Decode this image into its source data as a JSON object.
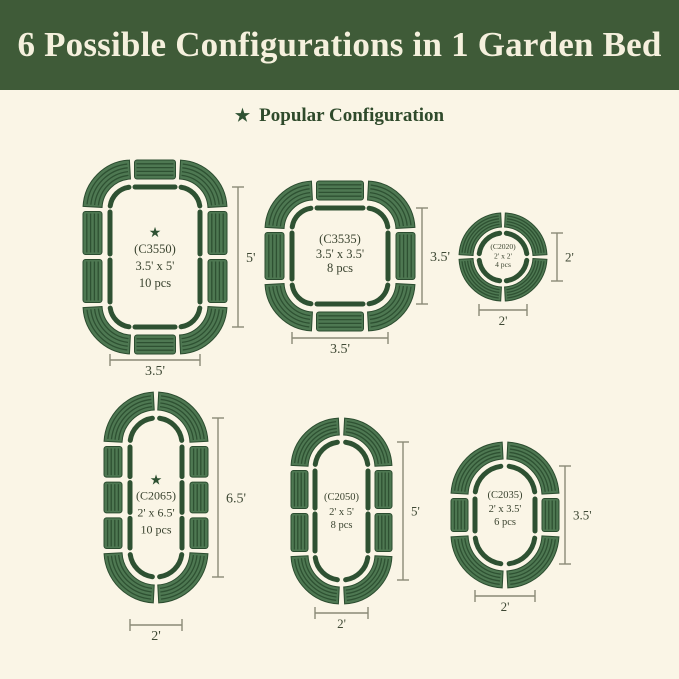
{
  "page": {
    "background": "#FAF5E6"
  },
  "header": {
    "title": "6 Possible Configurations in 1 Garden Bed",
    "background": "#3F5B38",
    "text_color": "#F5F0DD"
  },
  "legend": {
    "star_icon": "★",
    "label": "Popular Configuration",
    "text_color": "#2F4A2B"
  },
  "colors": {
    "panel_fill": "#4E7852",
    "panel_stripe": "#2E5132",
    "panel_edge": "#2B4C2F",
    "outline": "#2E5132",
    "dimension_line": "#8A8A77",
    "dimension_text": "#3E4834",
    "label_text": "#3A432F",
    "star": "#2E5132"
  },
  "configs": [
    {
      "id": "C3550",
      "code": "(C3550)",
      "size": "3.5' x 5'",
      "pieces": "10 pcs",
      "popular": true,
      "width_label": "3.5'",
      "height_label": "5'",
      "shape": "rounded-rectangle",
      "panels": {
        "corners": 4,
        "top": 1,
        "bottom": 1,
        "left": 2,
        "right": 2
      }
    },
    {
      "id": "C3535",
      "code": "(C3535)",
      "size": "3.5' x 3.5'",
      "pieces": "8 pcs",
      "popular": false,
      "width_label": "3.5'",
      "height_label": "3.5'",
      "shape": "rounded-square",
      "panels": {
        "corners": 4,
        "top": 1,
        "bottom": 1,
        "left": 1,
        "right": 1
      }
    },
    {
      "id": "C2020",
      "code": "(C2020)",
      "size": "2' x 2'",
      "pieces": "4 pcs",
      "popular": false,
      "width_label": "2'",
      "height_label": "2'",
      "shape": "circle",
      "panels": {
        "corners": 4,
        "top": 0,
        "bottom": 0,
        "left": 0,
        "right": 0
      }
    },
    {
      "id": "C2065",
      "code": "(C2065)",
      "size": "2' x 6.5'",
      "pieces": "10 pcs",
      "popular": true,
      "width_label": "2'",
      "height_label": "6.5'",
      "shape": "oval",
      "panels": {
        "corners": 4,
        "top": 0,
        "bottom": 0,
        "left": 3,
        "right": 3
      }
    },
    {
      "id": "C2050",
      "code": "(C2050)",
      "size": "2' x 5'",
      "pieces": "8 pcs",
      "popular": false,
      "width_label": "2'",
      "height_label": "5'",
      "shape": "oval",
      "panels": {
        "corners": 4,
        "top": 0,
        "bottom": 0,
        "left": 2,
        "right": 2
      }
    },
    {
      "id": "C2035",
      "code": "(C2035)",
      "size": "2' x 3.5'",
      "pieces": "6 pcs",
      "popular": false,
      "width_label": "2'",
      "height_label": "3.5'",
      "shape": "oval",
      "panels": {
        "corners": 4,
        "top": 0,
        "bottom": 0,
        "left": 1,
        "right": 1
      }
    }
  ]
}
